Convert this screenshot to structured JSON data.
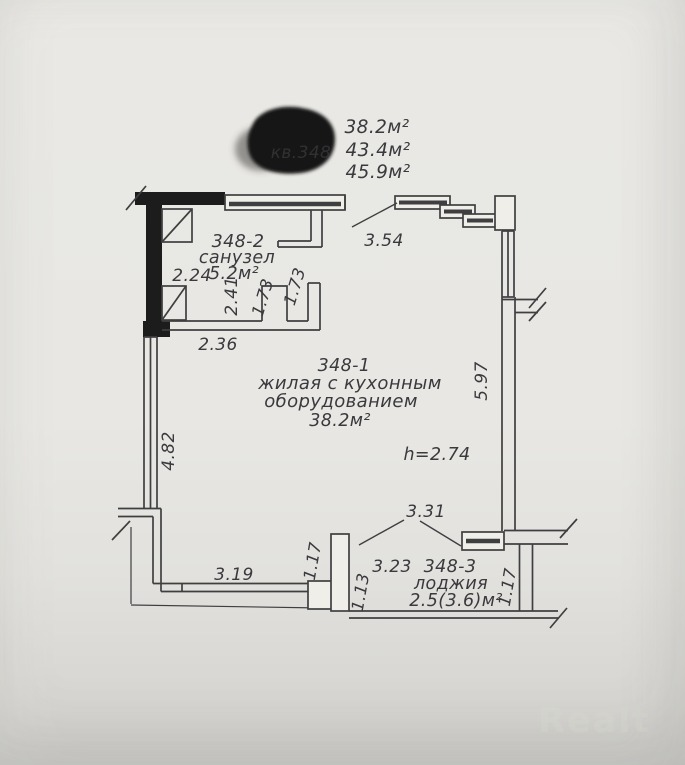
{
  "header": {
    "redacted_label": "кв.348",
    "areas": [
      "38.2м²",
      "43.4м²",
      "45.9м²"
    ]
  },
  "rooms": {
    "bathroom": {
      "id": "348-2",
      "name": "санузел",
      "area": "5.2м²"
    },
    "living": {
      "id": "348-1",
      "name1": "жилая с кухонным",
      "name2": "оборудованием",
      "area": "38.2м²"
    },
    "loggia": {
      "id": "348-3",
      "name": "лоджия",
      "area": "2.5(3.6)м²"
    }
  },
  "dims": {
    "bath_left": "2.24",
    "bath_inner": "2.41",
    "door_a": "1.73",
    "door_b": "1.73",
    "bath_width": "2.36",
    "entry_wall": "3.54",
    "left_wall": "4.82",
    "right_wall": "5.97",
    "ceiling": "h=2.74",
    "loggia_opening": "3.31",
    "loggia_inner_width": "3.23",
    "window_width": "3.19",
    "pier": "1.17",
    "loggia_left": "1.13",
    "loggia_right": "1.17"
  },
  "watermark": {
    "brand": "Realt"
  },
  "colors": {
    "line": "#3f3f41",
    "wall_black": "#1c1c1c",
    "paper": "#e8e7e3",
    "watermark": "#d8d8d2"
  }
}
